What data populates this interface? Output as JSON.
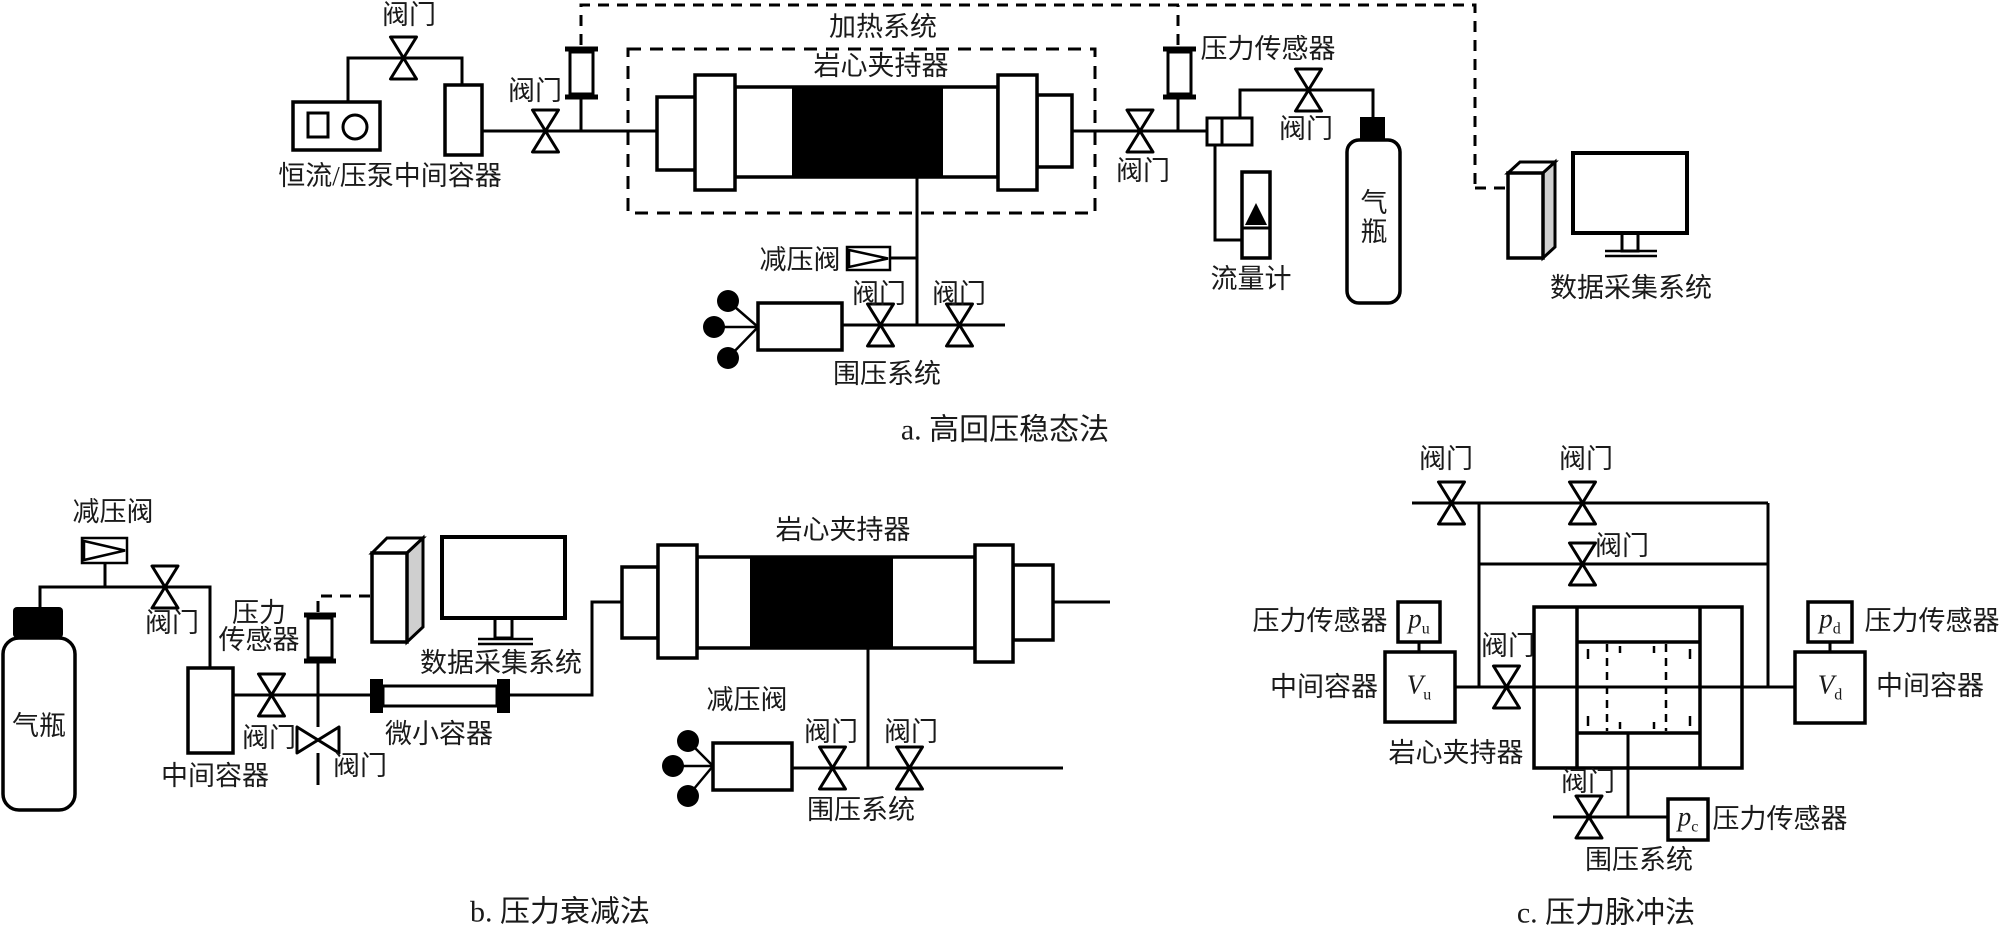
{
  "figure": {
    "title": "岩心渗透率测试装置示意图",
    "background": "#ffffff"
  },
  "common": {
    "valve": "阀门",
    "relief_valve": "减压阀",
    "pressure_sensor": "压力传感器",
    "confining_system": "围压系统",
    "core_holder": "岩心夹持器",
    "gas_cylinder": "气瓶",
    "daq": "数据采集系统",
    "intermediate_container": "中间容器"
  },
  "diagram_a": {
    "caption": "a. 高回压稳态法",
    "heating_system": "加热系统",
    "pump_container": "恒流/压泵中间容器",
    "flow_meter": "流量计"
  },
  "diagram_b": {
    "caption": "b. 压力衰减法",
    "micro_container": "微小容器",
    "ps_line1": "压力",
    "ps_line2": "传感器"
  },
  "diagram_c": {
    "caption": "c. 压力脉冲法",
    "pu_base": "p",
    "pu_sub": "u",
    "pd_base": "p",
    "pd_sub": "d",
    "pc_base": "p",
    "pc_sub": "c",
    "vu_base": "V",
    "vu_sub": "u",
    "vd_base": "V",
    "vd_sub": "d"
  },
  "colors": {
    "line": "#000000",
    "background": "#ffffff",
    "core_fill": "#000000",
    "tower_side": "#cfcfcf"
  }
}
